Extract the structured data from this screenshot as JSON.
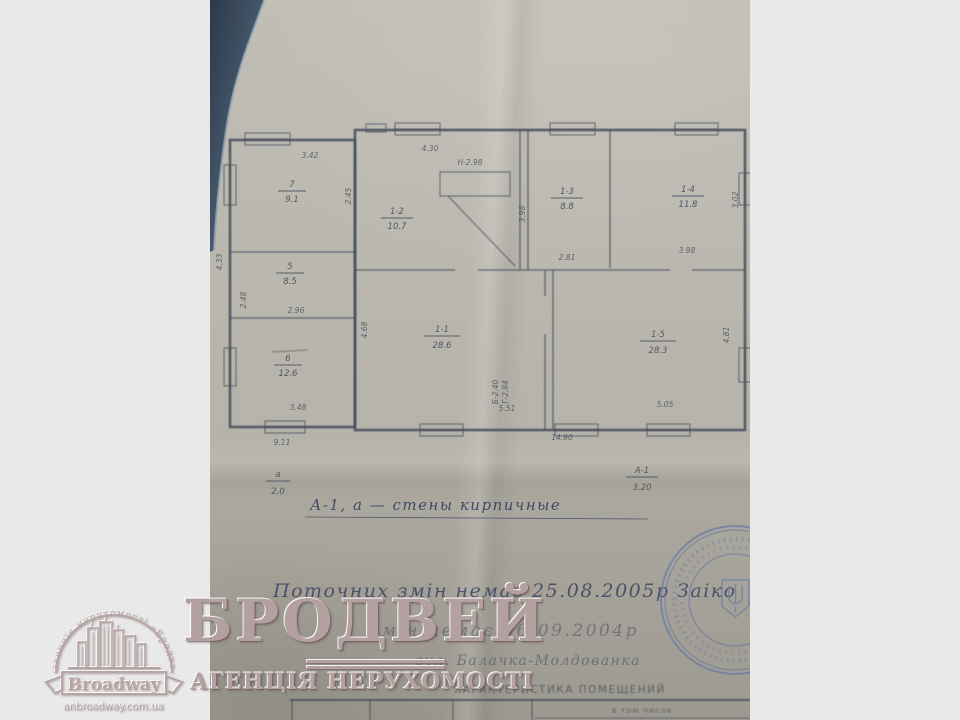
{
  "colors": {
    "margin": "#e9e9e9",
    "paper": "#b1aea4",
    "ink": "#474e60",
    "stamp_blue": "#5d74a6",
    "watermark_pink": "#b3a0a0"
  },
  "plan": {
    "rooms": [
      {
        "id": "7",
        "area": "9.1"
      },
      {
        "id": "5",
        "area": "8.5"
      },
      {
        "id": "6",
        "area": "12.6"
      },
      {
        "id": "1-2",
        "area": "10.7"
      },
      {
        "id": "1-3",
        "area": "8.8"
      },
      {
        "id": "1-4",
        "area": "11.8"
      },
      {
        "id": "1-1",
        "area": "28.6"
      },
      {
        "id": "1-5",
        "area": "28.3"
      }
    ],
    "dims": {
      "top_annex": "3.42",
      "top_main": "4.30",
      "height_note": "Н-2.98",
      "v_r1_right": "2.45",
      "v_mid": "3.98",
      "v_right_top": "3.02",
      "r13_bottom": "2.81",
      "r14_bottom": "3.98",
      "annex_mid": "2.96",
      "annex_bottom": "3.48",
      "v_r11_left": "4.68",
      "r11_bottom": "5.51",
      "v_b1": "Б-2.40",
      "v_b2": "Г-2.84",
      "r15_bottom": "5.05",
      "v_r15_right": "4.81",
      "v_left_outer": "4.33",
      "v_left_inner": "2.48",
      "bottom_left": "9.11",
      "bottom_main": "14.90"
    },
    "fractions": {
      "left": {
        "top": "а",
        "bottom": "2.0"
      },
      "right": {
        "top": "А-1",
        "bottom": "3.20"
      }
    },
    "note": "А-1, а — стены кирпичные"
  },
  "handwriting": {
    "line1": "Поточних змін немає 25.08.2005р Заіко",
    "line2": "змін немає 06.09.2004р",
    "line3": "вул. Балачка-Молдованка"
  },
  "table": {
    "title": "ХАРАКТЕРИСТИКА ПОМЕЩЕНИЙ",
    "in_total": "в том числе"
  },
  "watermark": {
    "title": "БРОДВЕЙ",
    "subtitle": "АГЕНЦІЯ НЕРУХОМОСТІ",
    "logo_arc": "агенція нерухомості «Бродвей»",
    "logo_name": "Broadway",
    "logo_site": "anbroadway.com.ua"
  }
}
